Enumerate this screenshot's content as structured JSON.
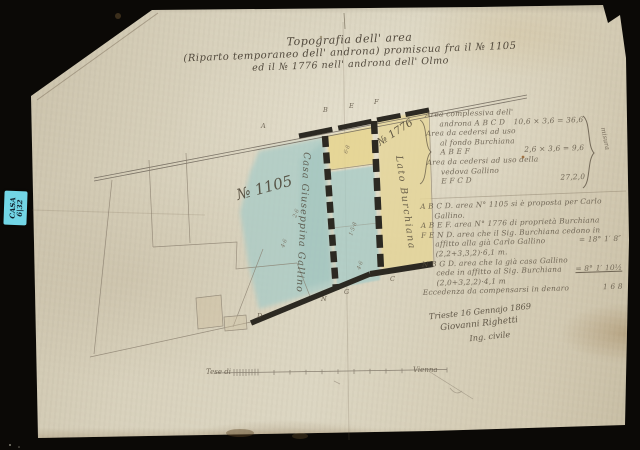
{
  "archive_label": {
    "line1": "CASA",
    "line2": "6|32"
  },
  "title": {
    "line1": "Topografia dell' area",
    "line2": "(Riparto temporaneo dell' androna) promiscua fra il № 1105",
    "line3": "ed il № 1776 nell' androna dell' Olmo"
  },
  "plan": {
    "parcel_left_label": "№ 1105",
    "parcel_right_label": "№ 1776",
    "owner_left_strip": "Casa Giuseppina Gallino",
    "owner_right_strip": "Lato Burchiana",
    "point_labels": {
      "a": "A",
      "b": "B",
      "e": "E",
      "f": "F",
      "d": "D",
      "n": "N",
      "g": "G",
      "c": "C"
    },
    "measures": {
      "m1": "6·8",
      "m2": "1·5·8",
      "m3": "4·6",
      "m4": "2·6",
      "m5": "4·6"
    },
    "colors": {
      "wash_blue": "#a6cbc7",
      "wash_yellow": "#e7d58f",
      "wall": "#2c2922",
      "pencil": "#857a6a",
      "ink": "#5c5344",
      "paper": "#d8d1bc",
      "backdrop": "#0b0906",
      "sticker": "#72d6e6"
    }
  },
  "annotations": {
    "block1": {
      "l1": "Area complessiva dell'",
      "l2": "androna  A B C D",
      "l2v": "10,6 × 3,6 = 36,6",
      "l3": "Area da cedersi ad uso",
      "l4": "al fondo Burchiana",
      "l5": "A B E F",
      "l5v": "2,6 × 3,6 = 9,6",
      "l6": "Area da cedersi ad uso della",
      "l7": "vedova Gallino",
      "l8": "E F C D",
      "l8v": "27,2,0",
      "brace_label": "misura"
    },
    "block2": {
      "l1": "A B C D. area N° 1105 si è proposta per Carlo",
      "l2": "Gallino.",
      "l3": "A B E F. area N° 1776 di proprietà Burchiana",
      "l4": "F E N D. area che il Sig. Burchiana cedono in",
      "l5": "affitto alla già Carlo Gallino (2,2+3,3,2)·6,1 m.",
      "l5v": "=  18° 1′ 8″",
      "l6": "N B G D. area che la già casa Gallino",
      "l7": "cede in affitto al Sig. Burchiana (2,0+3,2,2)·4,1 m",
      "l7v": "=  8° 1′ 10½",
      "l8": "Eccedenza da compensarsi in denaro",
      "l8v": "1  6  8"
    }
  },
  "signature": {
    "line1": "Trieste 16 Gennajo 1869",
    "line2": "Giovanni Righetti",
    "line3": "Ing. civile"
  },
  "scale_bar": {
    "left_label": "Tese di",
    "right_label": "Vienna"
  }
}
